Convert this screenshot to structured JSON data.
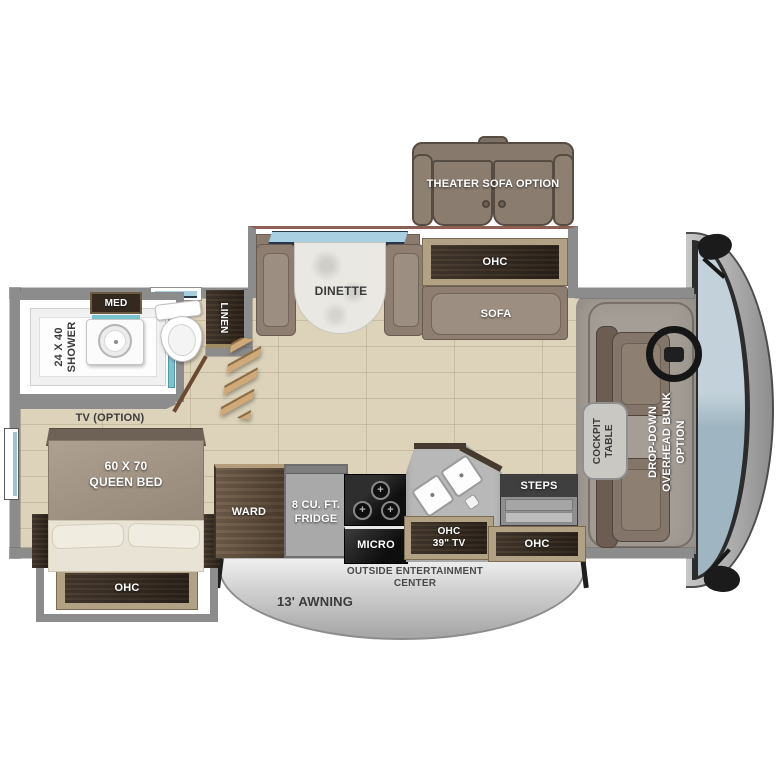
{
  "labels": {
    "theater_sofa": "THEATER SOFA OPTION",
    "ohc_living": "OHC",
    "sofa": "SOFA",
    "dinette": "DINETTE",
    "med": "MED",
    "linen": "LINEN",
    "shower": "24 X 40\nSHOWER",
    "tv_option": "TV (OPTION)",
    "queen_bed": "60 X 70\nQUEEN BED",
    "ohc_bed": "OHC",
    "ward": "WARD",
    "fridge": "8 CU. FT.\nFRIDGE",
    "micro": "MICRO",
    "ohc_tv": "OHC\n39\" TV",
    "steps": "STEPS",
    "ohc_entry": "OHC",
    "outside_entertainment": "OUTSIDE ENTERTAINMENT\nCENTER",
    "awning": "13' AWNING",
    "cockpit_table": "COCKPIT\nTABLE",
    "drop_down_bunk": "DROP-DOWN\nOVERHEAD BUNK\nOPTION"
  },
  "colors": {
    "floor_tile": "#ddd3ba",
    "wall_gray": "#8c8c8c",
    "cabinet_wood_dark": "#382d23",
    "cabinet_trim_tan": "#b2a285",
    "upholstery_taupe": "#8d7e71",
    "windshield_blue": "#b6c8d2",
    "glass_teal": "#7cc3cf",
    "awning_silver": "#c9c9c9",
    "label_dark": "#3b3b3b"
  }
}
